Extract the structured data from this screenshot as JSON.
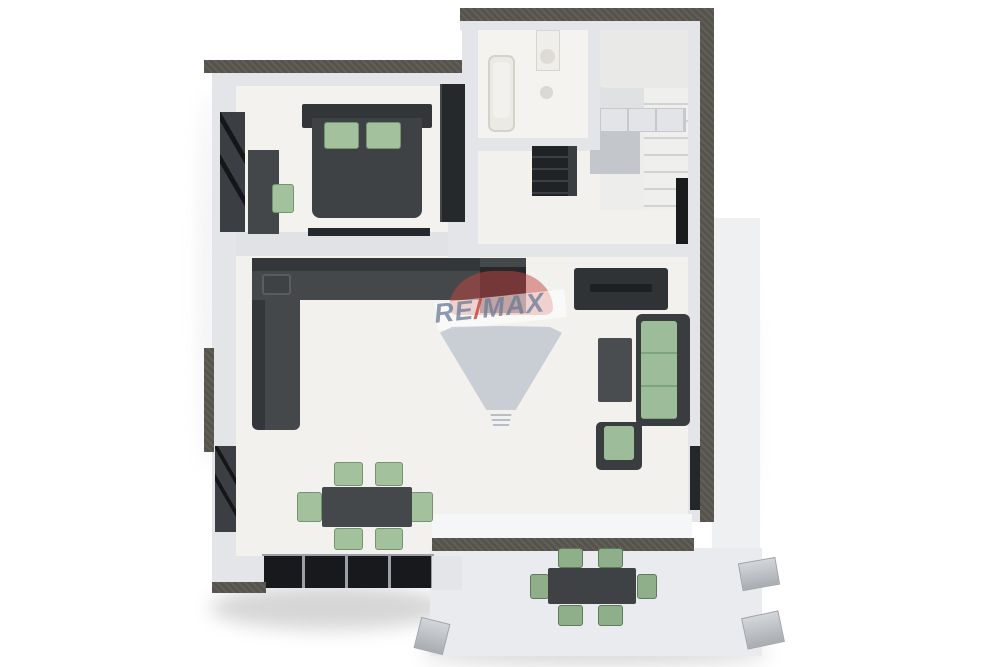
{
  "watermark": {
    "re": "RE",
    "slash": "/",
    "max": "MAX",
    "full_brand": "RE/MAX",
    "canopy_color": "#c4463f",
    "body_color": "#9aa8ba",
    "text_blue": "#687a96",
    "text_red": "#c43e38"
  },
  "palette": {
    "background": "#ffffff",
    "floor": "#f2f1ee",
    "wall_face": "#e3e5e8",
    "wall_cut_dark": "#56534d",
    "furniture_dark": "#3d4043",
    "furniture_black": "#26292c",
    "accent_green": "#a2c19c",
    "outdoor_green": "#8fae8a",
    "terrace_floor": "#e9ebee",
    "stair_tread": "#ececea"
  },
  "scene": {
    "type": "3d-floor-plan-render",
    "view": "top-down",
    "rooms": [
      {
        "name": "bedroom",
        "items": [
          "double-bed",
          "green-pillows",
          "headboard",
          "wardrobe",
          "desk",
          "desk-chair",
          "window-panels",
          "window-sill"
        ]
      },
      {
        "name": "bathroom",
        "items": [
          "bathtub",
          "washbasin-vanity",
          "ceiling-lamp"
        ]
      },
      {
        "name": "staircase",
        "items": [
          "winder-steps",
          "straight-flight",
          "landing",
          "storage-niche"
        ]
      },
      {
        "name": "hallway",
        "items": [
          "shelf-unit"
        ]
      },
      {
        "name": "kitchen",
        "items": [
          "l-shaped-counter",
          "sink",
          "tall-cabinet"
        ]
      },
      {
        "name": "living-room",
        "items": [
          "tv-console",
          "sofa",
          "coffee-table",
          "armchair",
          "dining-table",
          "six-dining-chairs",
          "glazed-wall"
        ]
      },
      {
        "name": "terrace",
        "items": [
          "outdoor-dining-table",
          "six-outdoor-chairs",
          "railing-posts"
        ]
      }
    ]
  }
}
